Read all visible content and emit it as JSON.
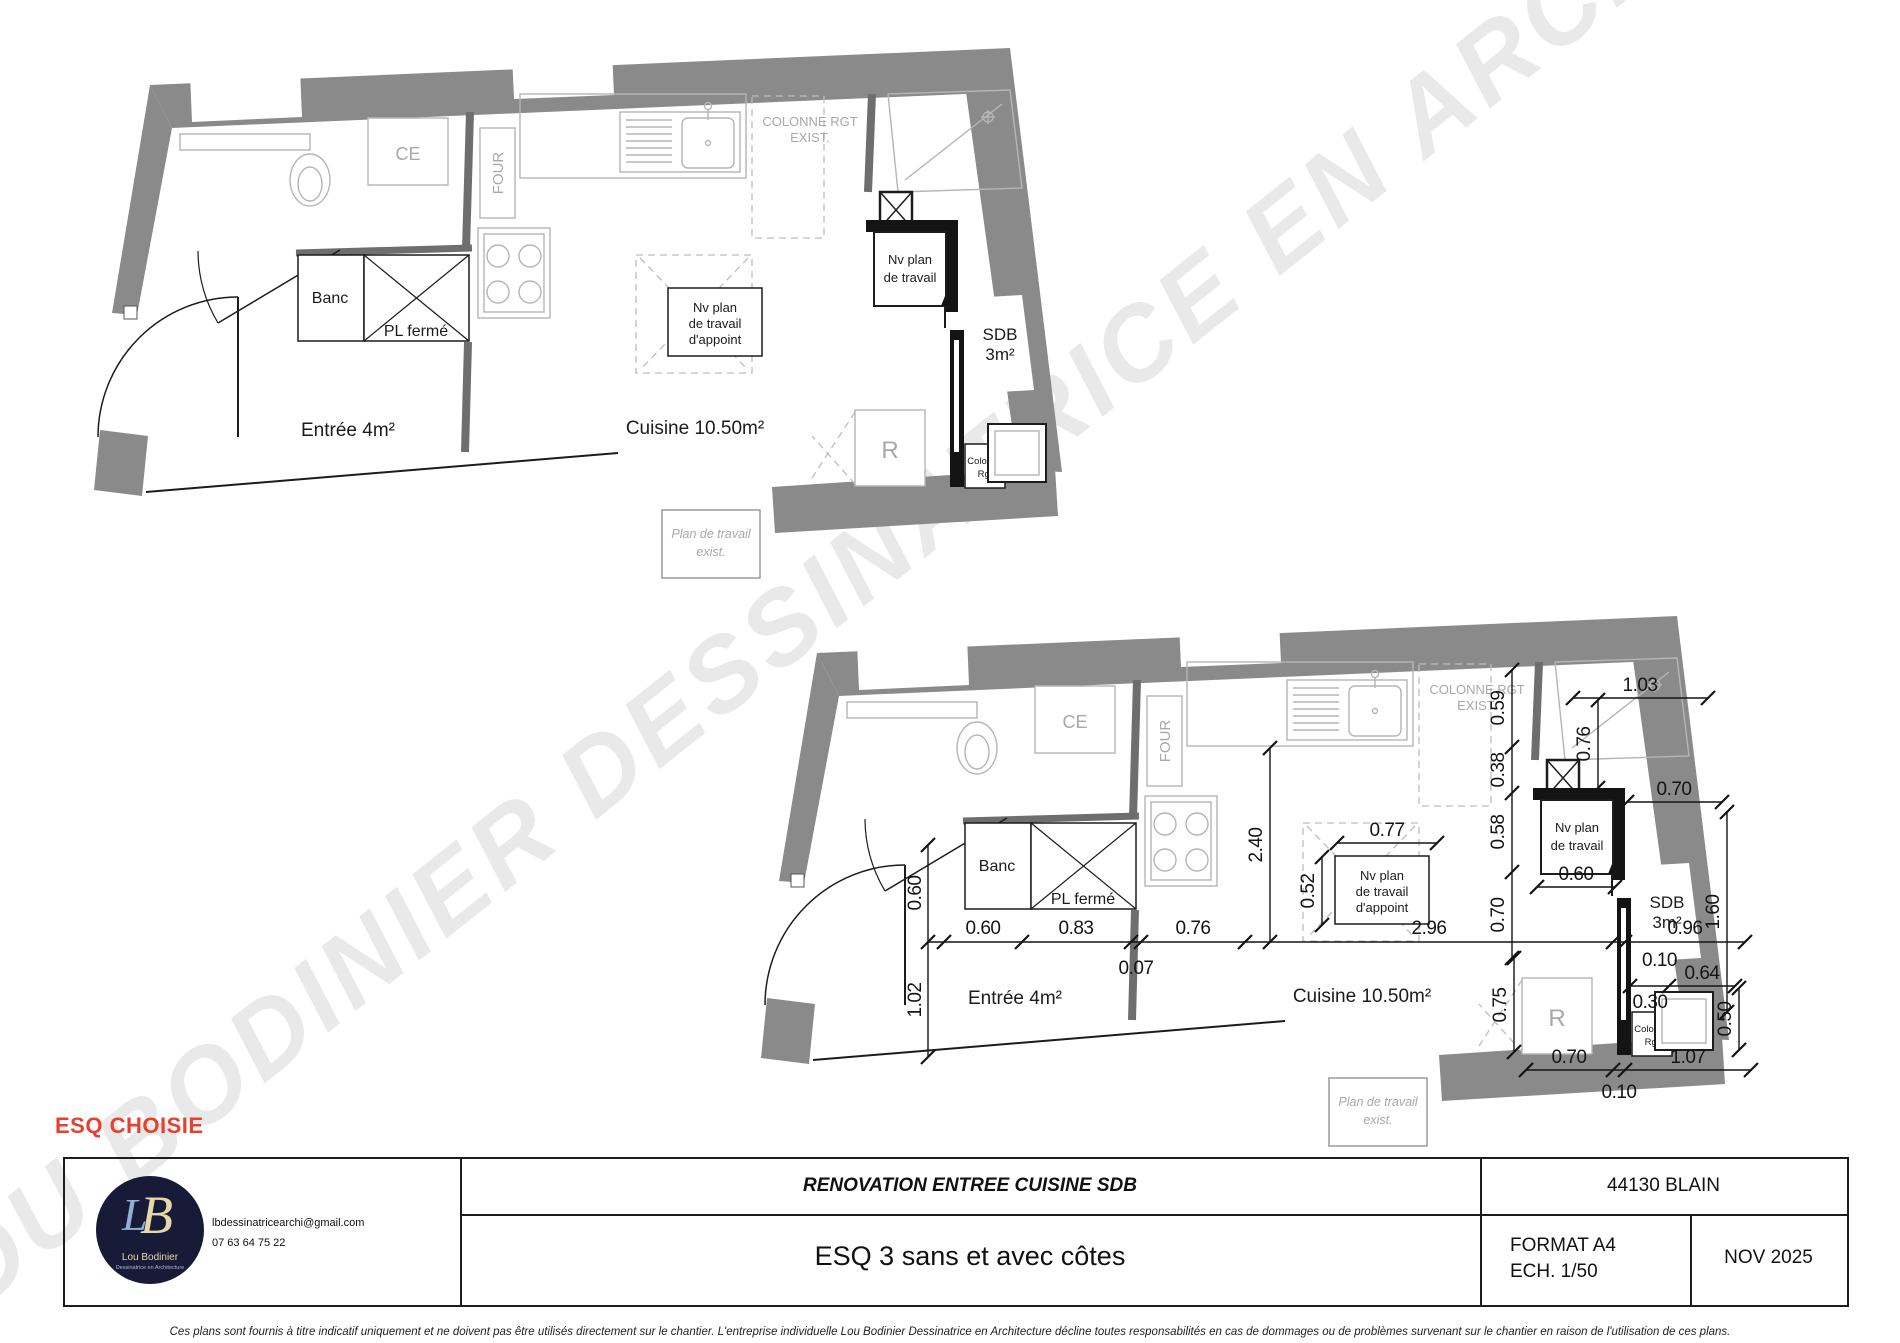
{
  "watermark": {
    "text": "LOU BODINIER DESSINATRICE EN ARCHITECTURE"
  },
  "status_label": "ESQ CHOISIE",
  "plan": {
    "labels": {
      "ce": "CE",
      "four": "FOUR",
      "banc": "Banc",
      "pl_ferme": "PL fermé",
      "entree": "Entrée 4m²",
      "cuisine": "Cuisine 10.50m²",
      "sdb_1": "SDB",
      "sdb_2": "3m²",
      "colonne_exist_1": "COLONNE RGT",
      "colonne_exist_2": "EXIST.",
      "nv_plan_1": "Nv plan",
      "nv_plan_2": "de travail",
      "nv_appoint_1": "Nv plan",
      "nv_appoint_2": "de travail",
      "nv_appoint_3": "d'appoint",
      "colonne_1": "Colonne",
      "colonne_2": "Rgt",
      "r": "R",
      "plan_exist_1": "Plan de travail",
      "plan_exist_2": "exist."
    },
    "dims": {
      "d007": "0.07",
      "d010": "0.10",
      "d030": "0.30",
      "d038": "0.38",
      "d050": "0.50",
      "d052": "0.52",
      "d058": "0.58",
      "d059": "0.59",
      "d060": "0.60",
      "d064": "0.64",
      "d070": "0.70",
      "d075": "0.75",
      "d076": "0.76",
      "d077": "0.77",
      "d083": "0.83",
      "d096": "0.96",
      "d102": "1.02",
      "d103": "1.03",
      "d107": "1.07",
      "d160": "1.60",
      "d240": "2.40",
      "d296": "2.96"
    }
  },
  "titleblock": {
    "logo": {
      "monogram_l": "L",
      "monogram_b": "B",
      "name": "Lou Bodinier",
      "subtitle": "Dessinatrice en Architecture"
    },
    "email": "lbdessinatricearchi@gmail.com",
    "phone": "07 63 64 75 22",
    "project_title": "RENOVATION ENTREE CUISINE SDB",
    "city": "44130 BLAIN",
    "drawing_title": "ESQ 3 sans et avec côtes",
    "format": "FORMAT A4",
    "scale": "ECH. 1/50",
    "date": "NOV 2025"
  },
  "footer": {
    "disclaimer": "Ces plans sont fournis à titre indicatif  uniquement et ne doivent pas être utilisés directement sur le chantier. L'entreprise individuelle Lou Bodinier Dessinatrice en Architecture décline toutes responsabilités en cas de dommages ou de problèmes survenant sur le chantier en raison de l'utilisation de ces plans.",
    "colors": {
      "wall": "#8a8a8a",
      "accent_red": "#e8402e",
      "navy": "#171b38"
    }
  }
}
